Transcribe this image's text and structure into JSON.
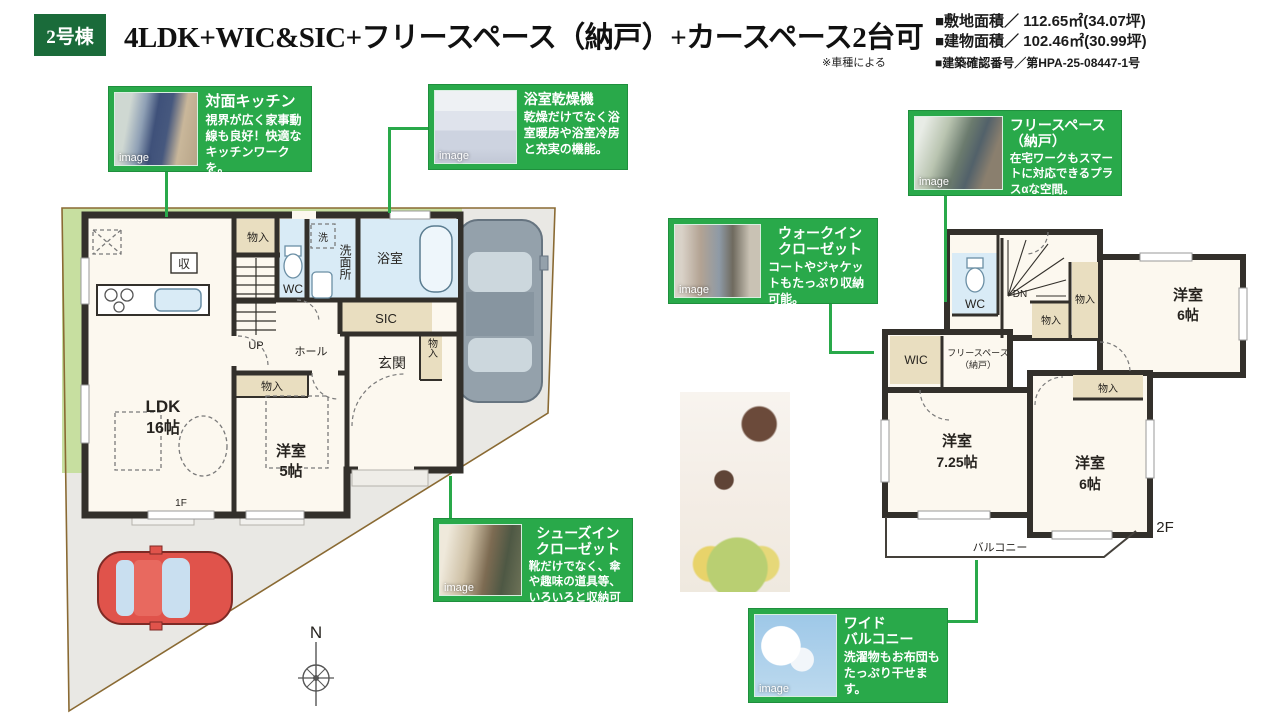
{
  "header": {
    "badge": "2号棟",
    "title": "4LDK+WIC&SIC+フリースペース（納戸）+カースペース2台可",
    "note": "※車種による",
    "specs": [
      "■敷地面積／ 112.65㎡(34.07坪)",
      "■建物面積／ 102.46㎡(30.99坪)",
      "■建築確認番号／第HPA-25-08447-1号"
    ]
  },
  "callouts": [
    {
      "title": "対面キッチン",
      "body": "視界が広く家事動線も良好！快適なキッチンワークを。"
    },
    {
      "title": "浴室乾燥機",
      "body": "乾燥だけでなく浴室暖房や浴室冷房と充実の機能。"
    },
    {
      "title": "フリースペース\n（納戸）",
      "body": "在宅ワークもスマートに対応できるプラスαな空間。"
    },
    {
      "title": "ウォークイン\nクローゼット",
      "body": "コートやジャケットもたっぷり収納可能。"
    },
    {
      "title": "シューズイン\nクローゼット",
      "body": "靴だけでなく、傘や趣味の道具等、いろいろと収納可能。"
    },
    {
      "title": "ワイド\nバルコニー",
      "body": "洗濯物もお布団もたっぷり干せます。"
    }
  ],
  "photo_watermark": "image",
  "floor1": {
    "floor_label": "1F",
    "ldk_name": "LDK",
    "ldk_size": "16帖",
    "bedroom_name": "洋室",
    "bedroom_size": "5帖",
    "bath": "浴室",
    "washroom": "洗面所",
    "wc": "WC",
    "washer": "洗",
    "storage": "収",
    "sic": "SIC",
    "entrance": "玄関",
    "hall": "ホール",
    "up": "UP",
    "closet": "物入"
  },
  "floor2": {
    "floor_label": "2F",
    "wc": "WC",
    "dn": "DN",
    "wic": "WIC",
    "free_space_line1": "フリースペース",
    "free_space_line2": "（納戸）",
    "bedroom6a_name": "洋室",
    "bedroom6a_size": "6帖",
    "bedroom725_name": "洋室",
    "bedroom725_size": "7.25帖",
    "bedroom6b_name": "洋室",
    "bedroom6b_size": "6帖",
    "balcony": "バルコニー",
    "closet": "物入"
  },
  "compass_label": "N",
  "colors": {
    "accent_green": "#29a94a",
    "badge_green": "#1a6b3a",
    "wall": "#33302b",
    "grass": "#c7dfa0",
    "pavement": "#e9e8e4",
    "wet_blue": "#d9ebf6",
    "closet_tan": "#e9dec0",
    "car_red": "#e0534b",
    "boundary": "#8a6a33"
  }
}
